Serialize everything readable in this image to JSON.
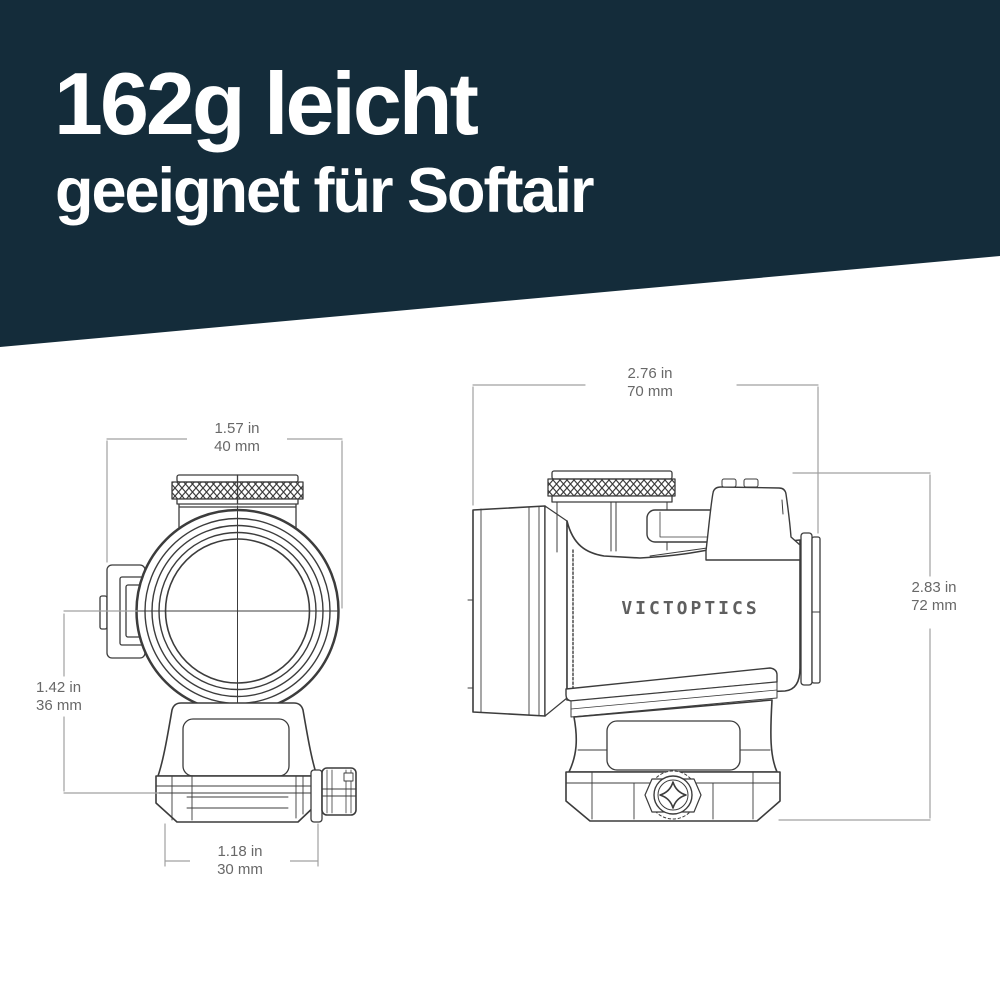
{
  "header": {
    "title": "162g leicht",
    "subtitle": "geeignet für Softair",
    "background": "#142c3a",
    "text_color": "#ffffff"
  },
  "drawing": {
    "brand": "VICTOPTICS",
    "stroke_color": "#3c3c3c",
    "dim_line_color": "#a0a0a0",
    "dim_text_color": "#686868",
    "dimensions": {
      "front_width": {
        "in": "1.57 in",
        "mm": "40 mm"
      },
      "front_height": {
        "in": "1.42 in",
        "mm": "36 mm"
      },
      "mount_width": {
        "in": "1.18 in",
        "mm": "30 mm"
      },
      "side_length": {
        "in": "2.76 in",
        "mm": "70 mm"
      },
      "side_height": {
        "in": "2.83 in",
        "mm": "72 mm"
      }
    }
  }
}
